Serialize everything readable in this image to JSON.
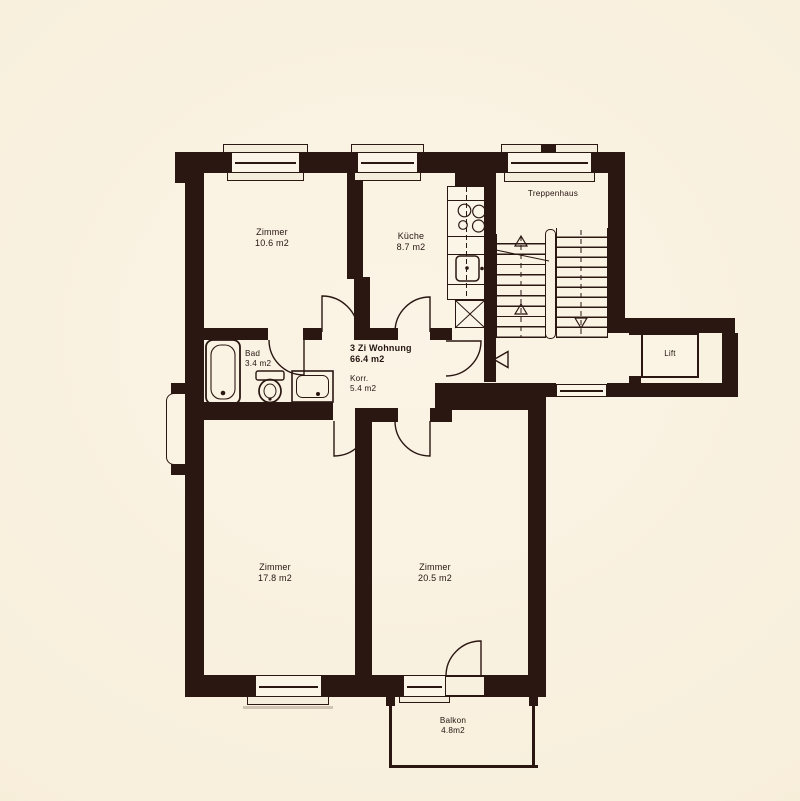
{
  "apartment": {
    "name": "3 Zi Wohnung",
    "area": "66.4 m2"
  },
  "rooms": {
    "zimmer_top": {
      "name": "Zimmer",
      "area": "10.6 m2"
    },
    "kueche": {
      "name": "Küche",
      "area": "8.7 m2"
    },
    "treppenhaus": {
      "name": "Treppenhaus"
    },
    "bad": {
      "name": "Bad",
      "area": "3.4 m2"
    },
    "korridor": {
      "name": "Korr.",
      "area": "5.4 m2"
    },
    "lift": {
      "name": "Lift"
    },
    "zimmer_left": {
      "name": "Zimmer",
      "area": "17.8 m2"
    },
    "zimmer_right": {
      "name": "Zimmer",
      "area": "20.5 m2"
    },
    "balkon": {
      "name": "Balkon",
      "area": "4.8m2"
    }
  },
  "colors": {
    "background": "#f8efdc",
    "wall": "#2a1712",
    "line": "#2a1712"
  },
  "icons": {
    "bathtub": "double-outline-rounded-rect",
    "toilet": "cistern-plus-oval",
    "washbasin": "rect-with-rounded-inset-and-drain-dot",
    "stove": "four-circles",
    "sink": "rounded-square-with-drain-dot",
    "stairs": "two-flights-step-lines-with-arrows",
    "entry-direction": "left-pointing-outline-triangle"
  }
}
